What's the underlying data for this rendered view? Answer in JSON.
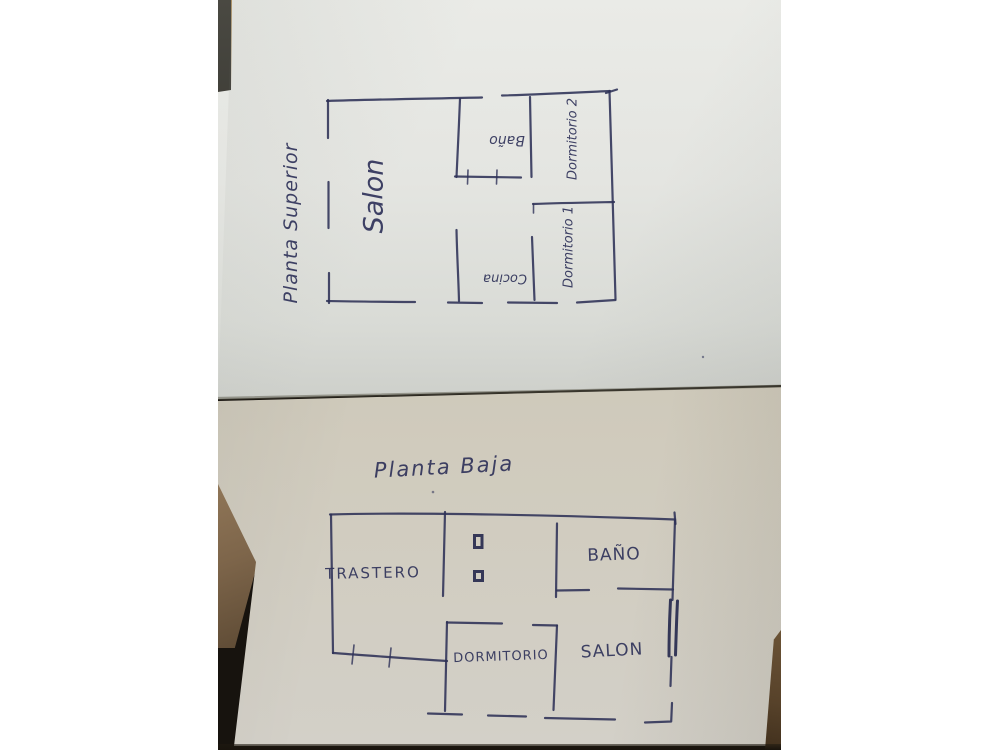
{
  "photo": {
    "description": "photograph of two hand-drawn floor plan sketches on paper sheets",
    "ink_color": "#2e3157",
    "paper_top_color": "#e4e5e1",
    "paper_bottom_color": "#cbc5b5",
    "upper_plan": {
      "title": "Planta Superior",
      "rooms": {
        "salon": "Salon",
        "bano": "Baño",
        "cocina": "Cocina",
        "dormitorio1": "Dormitorio 1",
        "dormitorio2": "Dormitorio 2"
      }
    },
    "lower_plan": {
      "title": "Planta Baja",
      "rooms": {
        "trastero": "TRASTERO",
        "bano": "BAÑO",
        "dormitorio": "DORMITORIO",
        "salon": "SALON"
      }
    }
  }
}
